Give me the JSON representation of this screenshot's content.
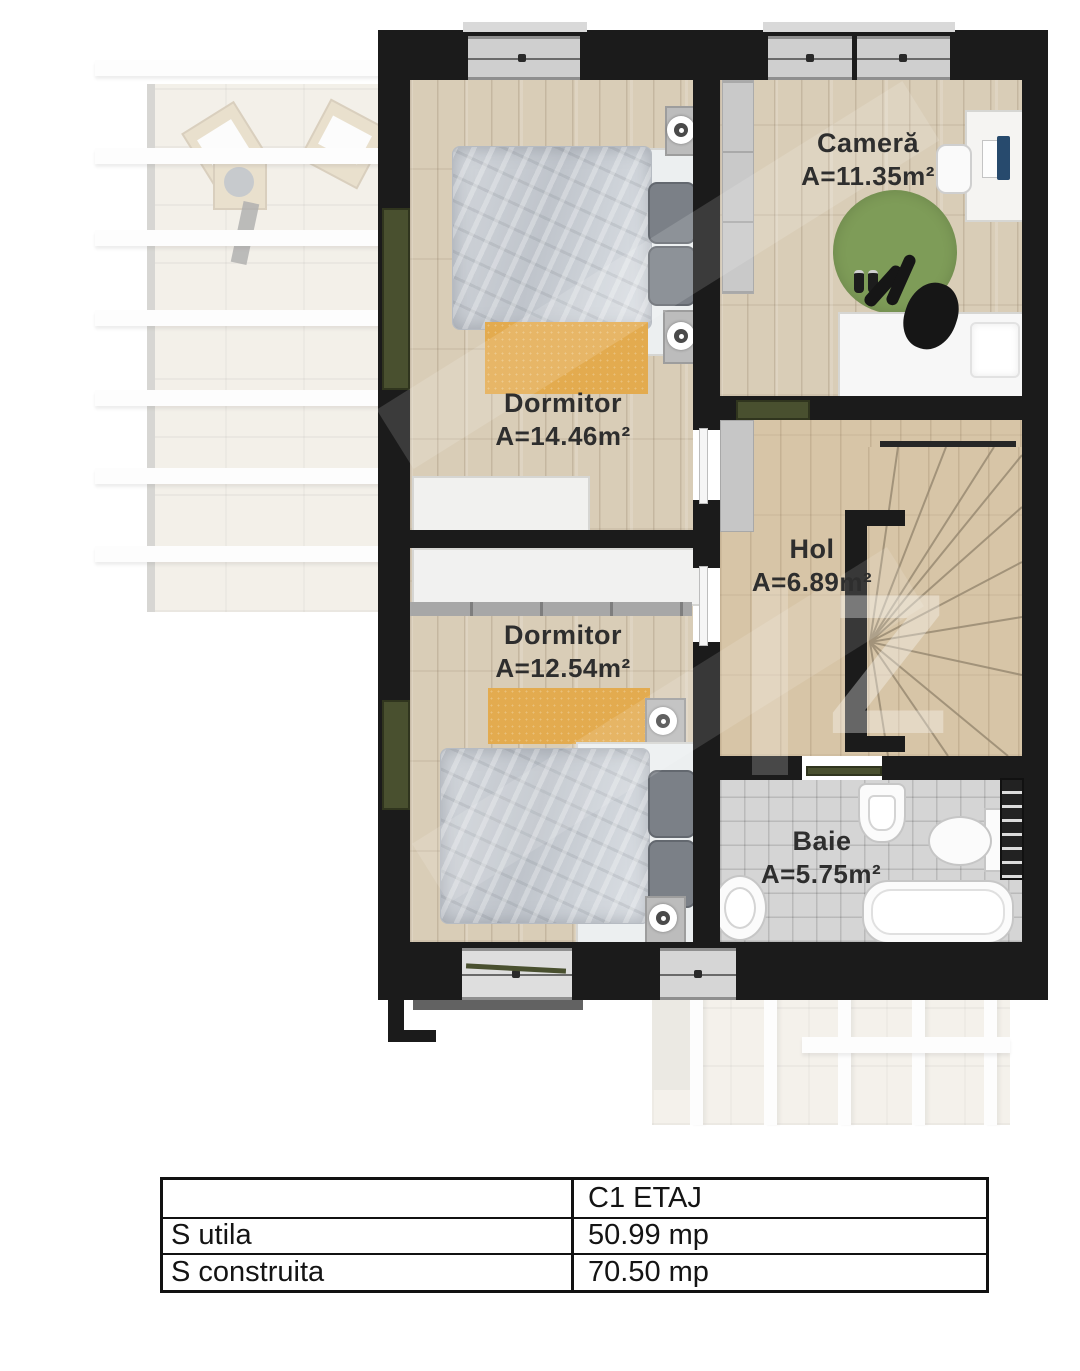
{
  "plan": {
    "rooms": [
      {
        "id": "camera",
        "name": "Cameră",
        "area": "A=11.35m²"
      },
      {
        "id": "dormitor-1",
        "name": "Dormitor",
        "area": "A=14.46m²"
      },
      {
        "id": "hol",
        "name": "Hol",
        "area": "A=6.89m²"
      },
      {
        "id": "dormitor-2",
        "name": "Dormitor",
        "area": "A=12.54m²"
      },
      {
        "id": "baie",
        "name": "Baie",
        "area": "A=5.75m²"
      }
    ],
    "watermark_glyph": "Z",
    "colors": {
      "wall": "#1b1b1b",
      "wood_floor": "#d9cdb7",
      "bath_tile": "#d5d5d5",
      "rug_orange": "#e3ab4f",
      "rug_green": "#7e9c58",
      "balcony_door_green": "#49502f"
    }
  },
  "summary_table": {
    "column_header": "C1 ETAJ",
    "rows": [
      {
        "label": "S utila",
        "value": "50.99 mp"
      },
      {
        "label": "S construita",
        "value": "70.50 mp"
      }
    ]
  }
}
